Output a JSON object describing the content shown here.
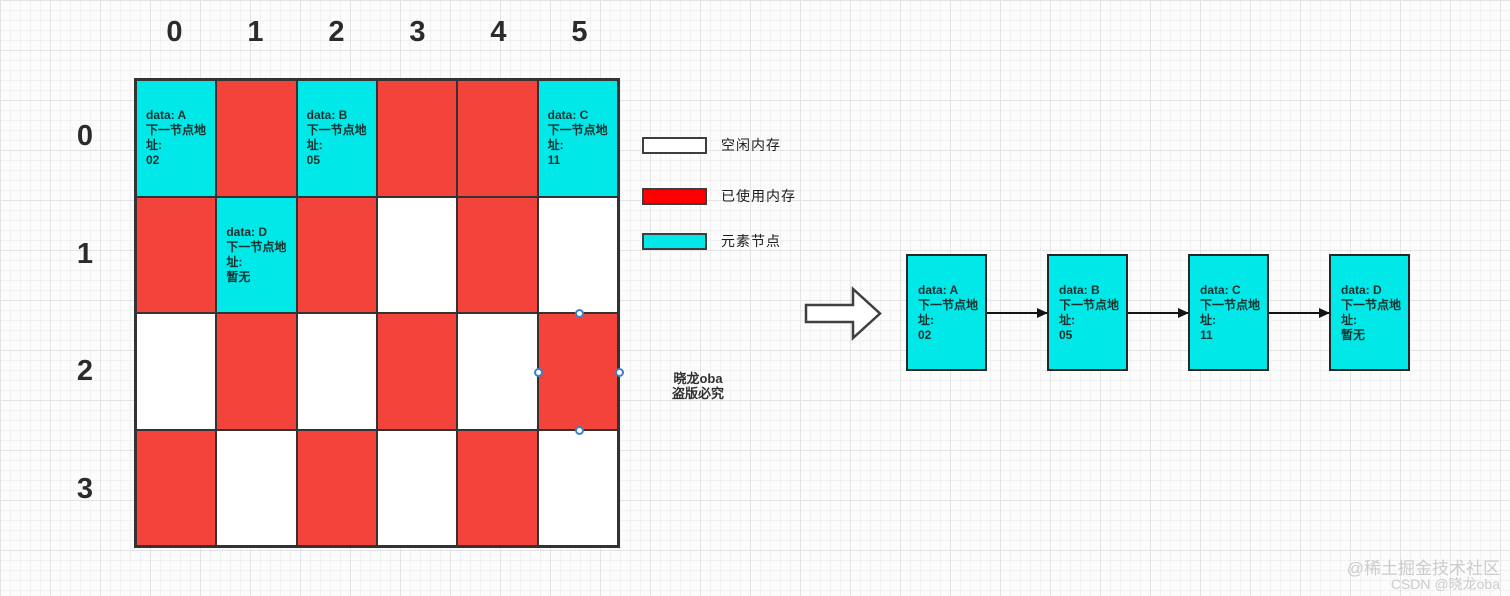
{
  "memory_grid": {
    "col_headers": [
      "0",
      "1",
      "2",
      "3",
      "4",
      "5"
    ],
    "row_headers": [
      "0",
      "1",
      "2",
      "3"
    ],
    "cells": [
      [
        {
          "type": "node",
          "lines": [
            "data: A",
            "下一节点地",
            "址:",
            "02"
          ]
        },
        {
          "type": "used"
        },
        {
          "type": "node",
          "lines": [
            "data: B",
            "下一节点地",
            "址:",
            "05"
          ]
        },
        {
          "type": "used"
        },
        {
          "type": "used"
        },
        {
          "type": "node",
          "lines": [
            "data: C",
            "下一节点地",
            "址:",
            "11"
          ]
        }
      ],
      [
        {
          "type": "used"
        },
        {
          "type": "node",
          "lines": [
            "data: D",
            "下一节点地",
            "址:",
            "暂无"
          ]
        },
        {
          "type": "used"
        },
        {
          "type": "free"
        },
        {
          "type": "used"
        },
        {
          "type": "free"
        }
      ],
      [
        {
          "type": "free"
        },
        {
          "type": "used"
        },
        {
          "type": "free"
        },
        {
          "type": "used"
        },
        {
          "type": "free"
        },
        {
          "type": "used",
          "selected": true
        }
      ],
      [
        {
          "type": "used"
        },
        {
          "type": "free"
        },
        {
          "type": "used"
        },
        {
          "type": "free"
        },
        {
          "type": "used"
        },
        {
          "type": "free"
        }
      ]
    ]
  },
  "legend": {
    "items": [
      {
        "id": "free",
        "label": "空闲内存",
        "color": "#ffffff"
      },
      {
        "id": "used",
        "label": "已使用内存",
        "color": "#ff0000"
      },
      {
        "id": "node",
        "label": "元素节点",
        "color": "#00e8e8"
      }
    ]
  },
  "linked_list": {
    "nodes": [
      {
        "lines": [
          "data: A",
          "下一节点地",
          "址:",
          "02"
        ]
      },
      {
        "lines": [
          "data: B",
          "下一节点地",
          "址:",
          "05"
        ]
      },
      {
        "lines": [
          "data: C",
          "下一节点地",
          "址:",
          "11"
        ]
      },
      {
        "lines": [
          "data: D",
          "下一节点地",
          "址:",
          "暂无"
        ]
      }
    ]
  },
  "watermarks": {
    "center": [
      "晓龙oba",
      "盗版必究"
    ],
    "corner": [
      "@稀土掘金技术社区",
      "CSDN @晓龙oba"
    ]
  },
  "colors": {
    "used_cell": "#f4433a",
    "node_cell": "#00e8e8",
    "legend_used": "#ff0000",
    "grid_border": "#333333",
    "handle_ring": "#3c82c9"
  }
}
